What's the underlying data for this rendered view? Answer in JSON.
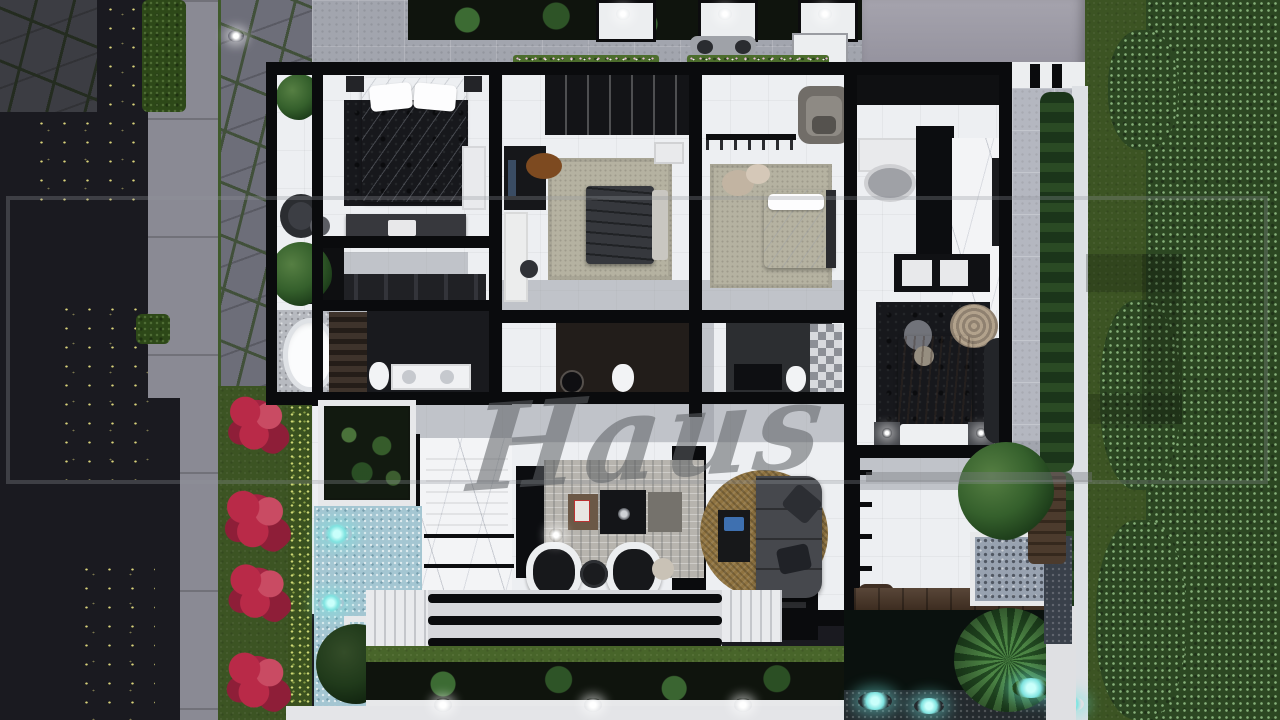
{
  "watermark": {
    "script_text": "Haus"
  },
  "palette": {
    "asphalt": "#1a1a20",
    "sidewalk": "#8a8a94",
    "flagstone": "#6d6e79",
    "flagstone_joint": "#41503a",
    "grass": "#3c5423",
    "grass_dark": "#2c4520",
    "bush": "#2c4722",
    "bush_highlight": "#86b07a",
    "flower_red": "#b92a48",
    "flower_red_dark": "#8e1e38",
    "hedge": "#2d4818",
    "floor_tile": "#edeff2",
    "wall_black": "#0a0b0d",
    "granite": "#a2a5ae",
    "roof_gray": "#9b99a4",
    "marble": "#f3f4f6",
    "rug_beige": "#b5b2a1",
    "rug_dark": "#17181c",
    "rug_study": "#b7b4ae",
    "wood_deck": "#4a3627",
    "sofa_tan": "#8f7340",
    "sofa_gray": "#46484d",
    "bed_taupe": "#93806f",
    "water_light": "#a4c6d2",
    "glow_cyan": "#7fe3e0",
    "pond_dark": "#0a110e",
    "pebble_wall": "#98a2b0",
    "path_white": "#e4e5e8",
    "plant_green": "#3c6032",
    "plant_dark": "#24401f",
    "accent_blue": "#3e70b0",
    "accent_orange": "#7d4a20",
    "watermark_gray": "#63666a"
  }
}
